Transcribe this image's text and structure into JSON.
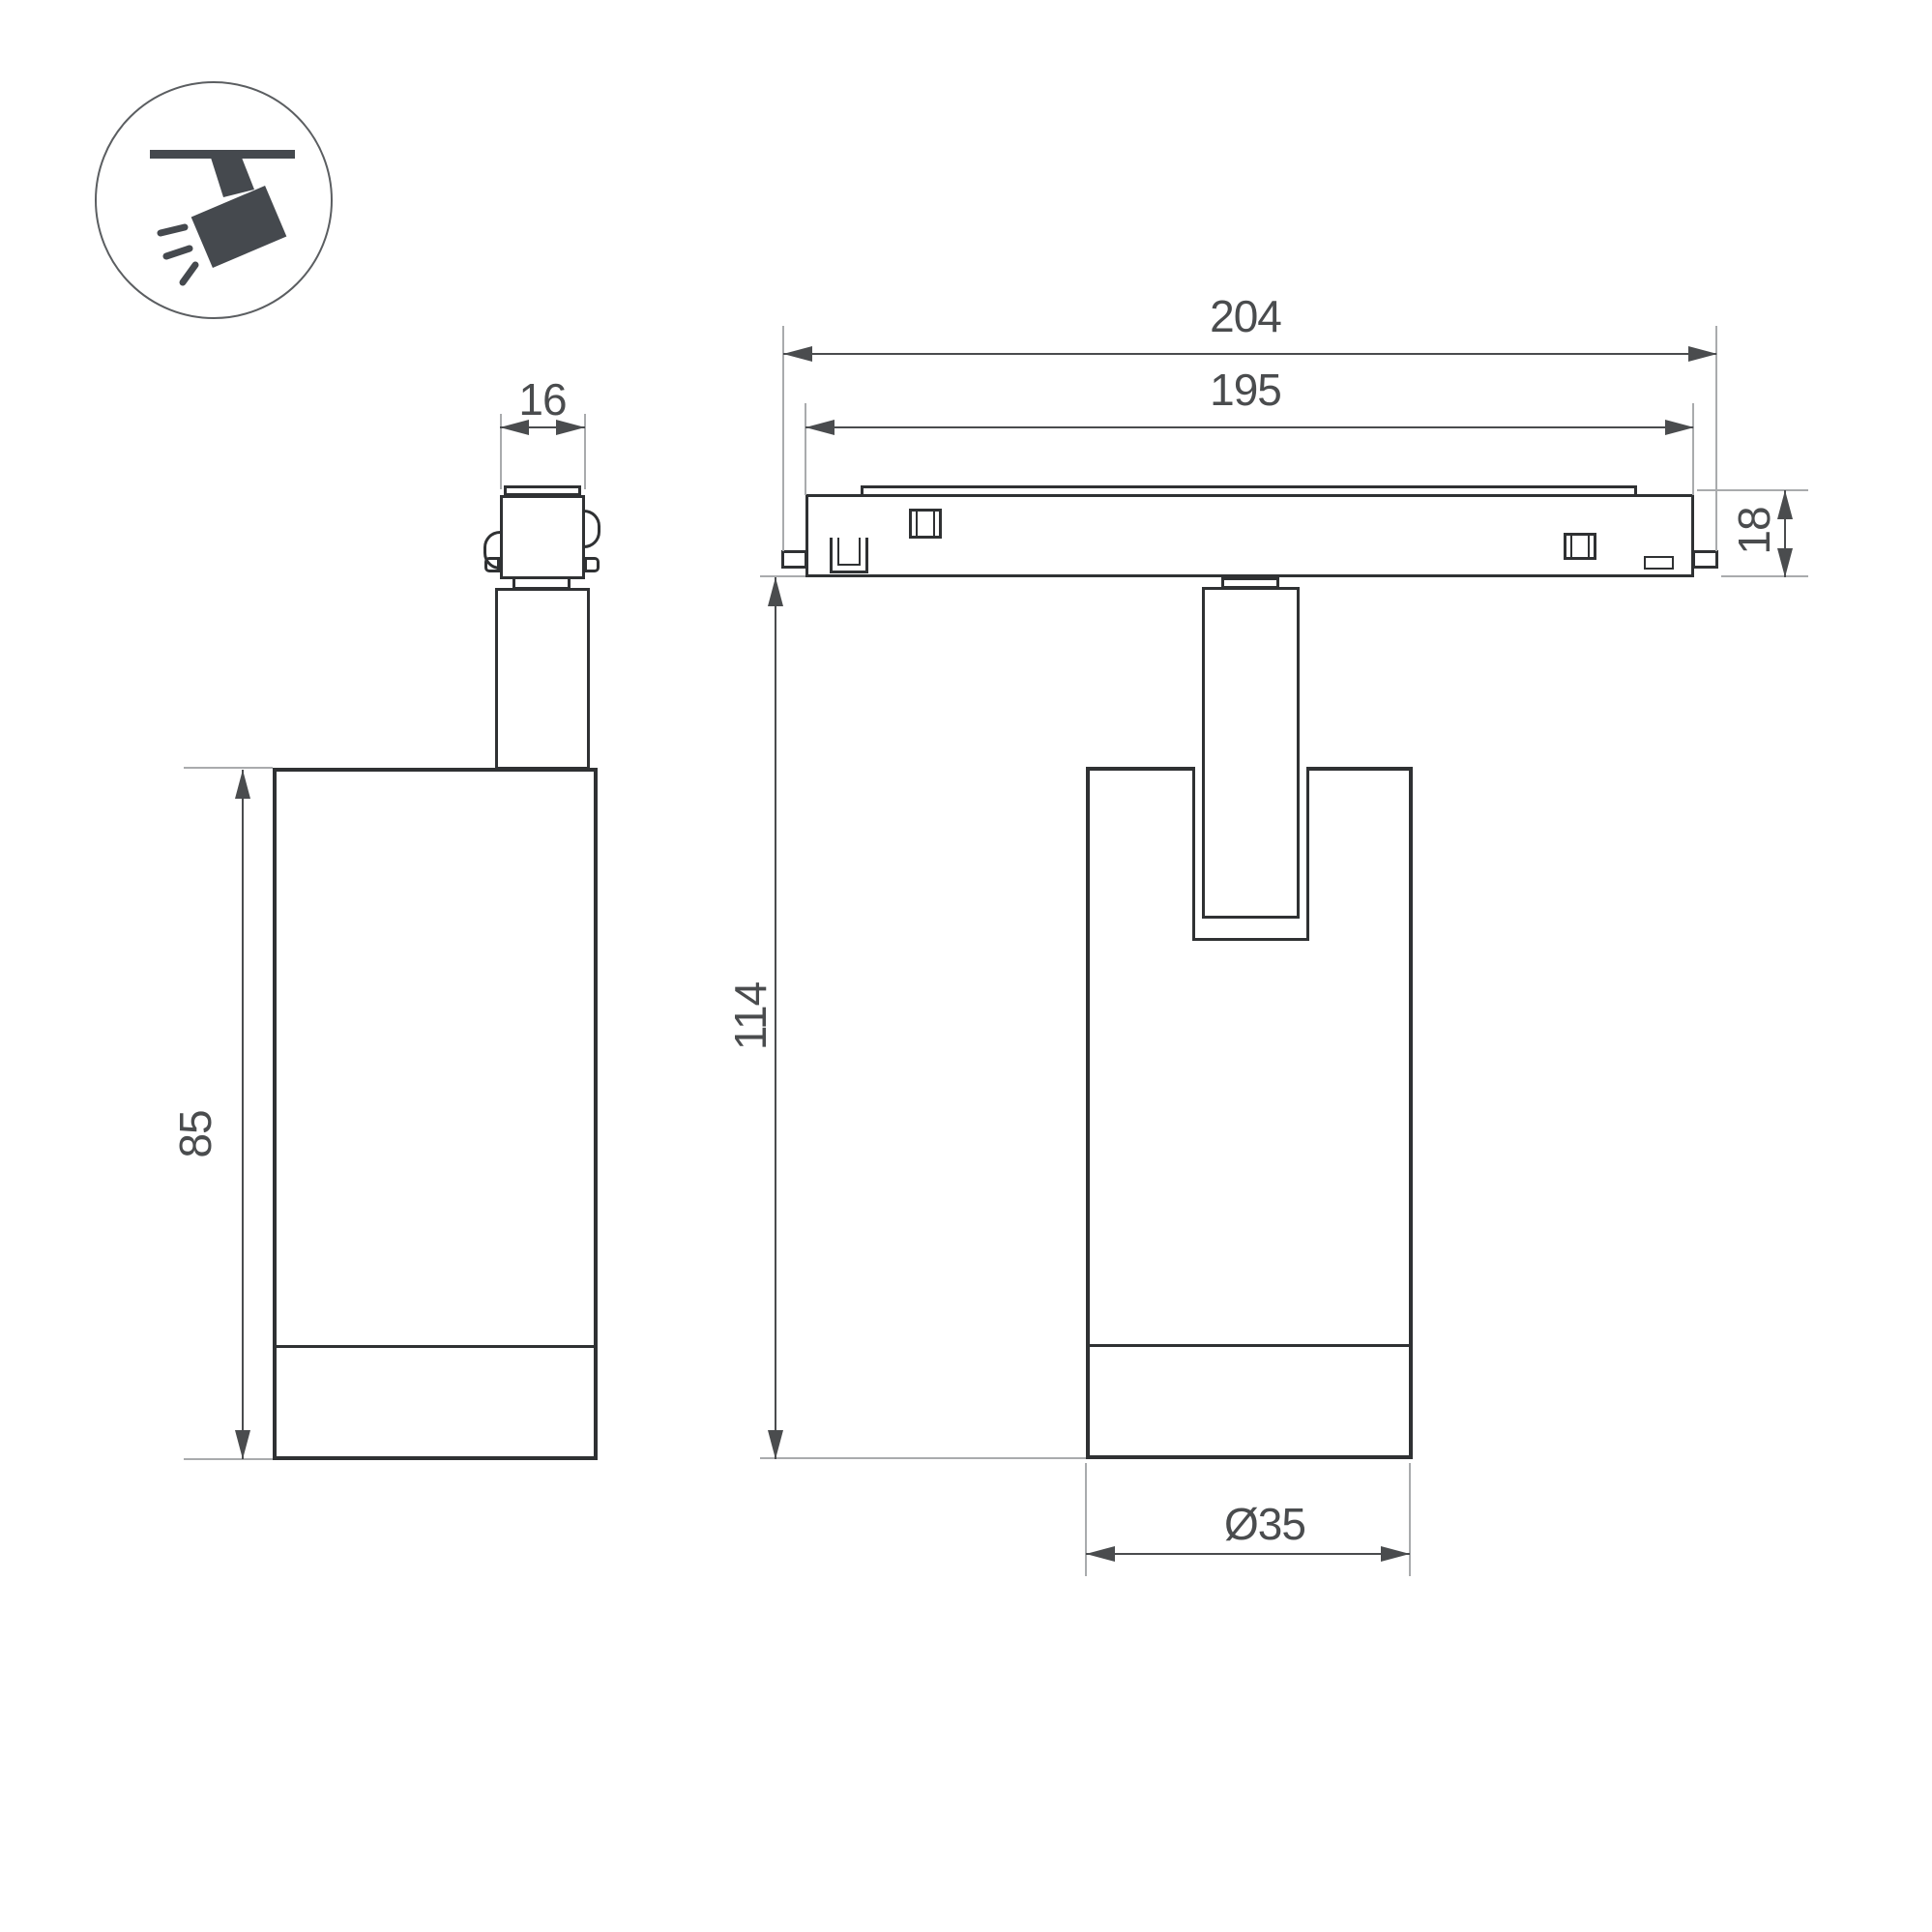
{
  "drawing": {
    "title": "track-spotlight-dimension-drawing",
    "background": "#ffffff",
    "line_color": "#2f3133",
    "dimension_color": "#4a4c4e",
    "extension_color": "#a9abad",
    "icon_color": "#45494e"
  },
  "icon": {
    "name": "ceiling-track-spotlight-pictogram"
  },
  "views": {
    "side_view": {
      "name": "side-view-of-luminaire"
    },
    "front_view": {
      "name": "front-view-with-track"
    }
  },
  "dimensions": {
    "adapter_width": "16",
    "track_overall_length": "204",
    "track_body_length": "195",
    "track_height": "18",
    "body_height": "85",
    "overall_height": "114",
    "body_diameter": "Ø35"
  }
}
